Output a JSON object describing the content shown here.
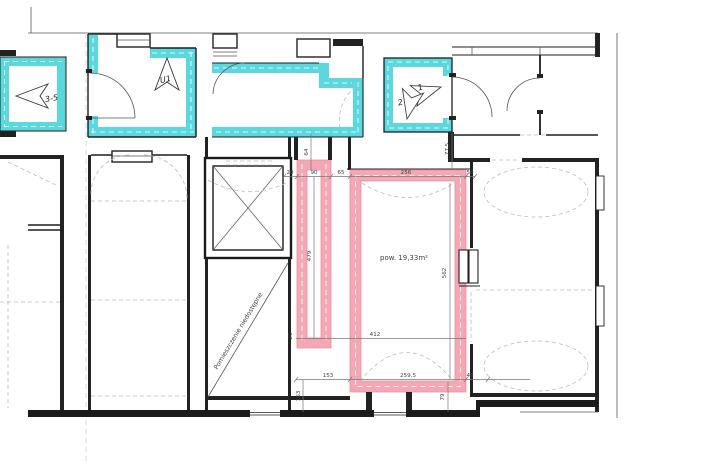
{
  "plan": {
    "title": "floor-plan-escape-routes",
    "colors": {
      "highlight_cyan": "#5BD7DE",
      "highlight_pink": "#F4A7B4",
      "pink_outline": "#EA8FA0",
      "wall": "#1F1F1F"
    },
    "labels": {
      "route_left": "3-5",
      "stair": "U1",
      "exit1": "1",
      "exit2": "2",
      "area": "pow. 19,33m²",
      "inaccessible": "Pomieszczenie niedostępne"
    },
    "dimensions": {
      "d64": "64",
      "d775": "77,5",
      "d20_top": "20",
      "d90": "90",
      "d65": "65",
      "d256": "256",
      "d50": "50",
      "d479": "479",
      "d562": "562",
      "d412": "412",
      "d20_mid": "20",
      "d153": "153",
      "d2595": "259,5",
      "d49": "49",
      "d163": "163",
      "d79": "79"
    }
  }
}
